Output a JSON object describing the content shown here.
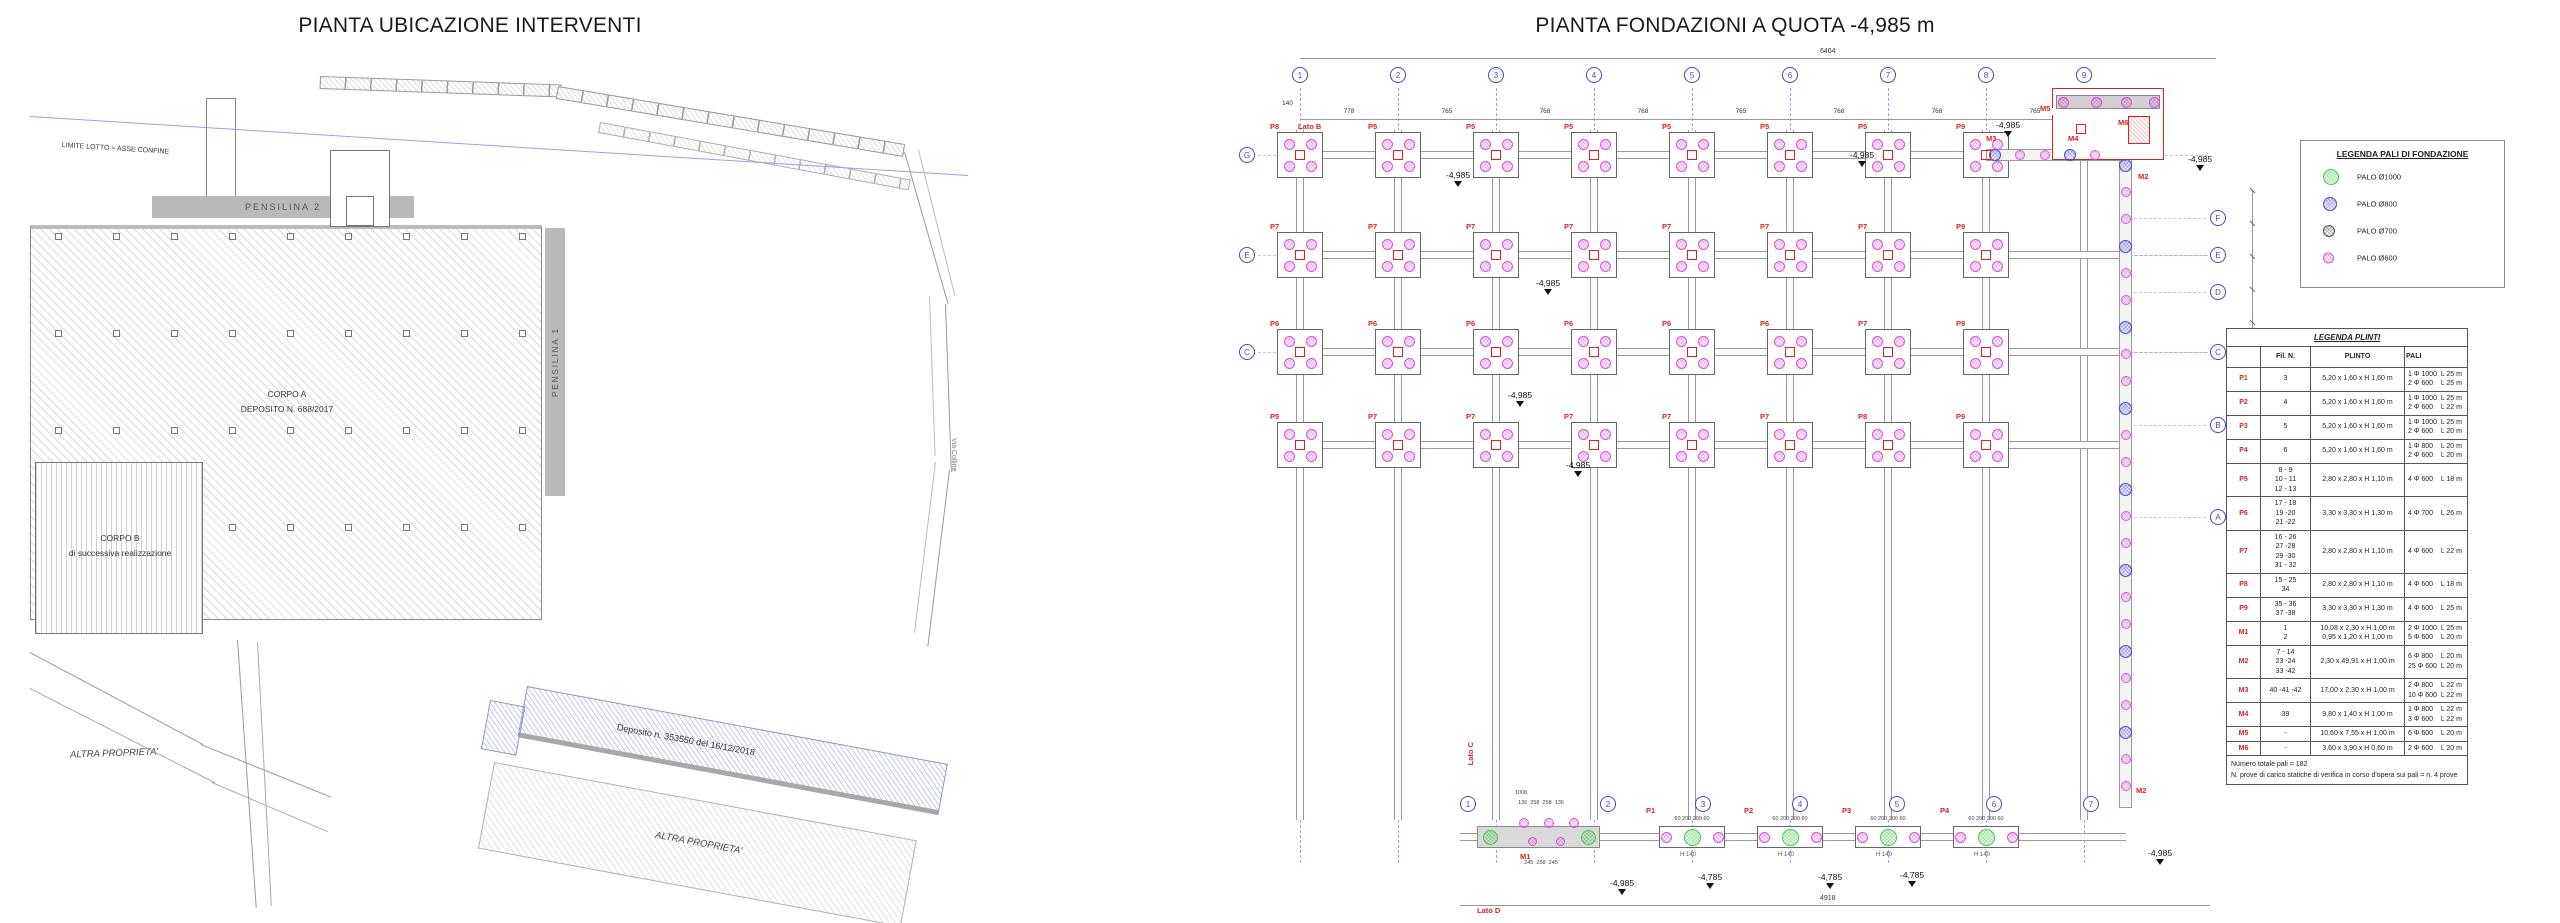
{
  "colors": {
    "palo_1000": "#44cc44",
    "palo_800": "#4a4ae8",
    "palo_700": "#555555",
    "palo_600": "#e050e0",
    "axis_blue": "#7d7de0",
    "red": "#e02020"
  },
  "left_plan": {
    "title": "PIANTA UBICAZIONE INTERVENTI",
    "labels": {
      "limite_lotto": "LIMITE LOTTO = ASSE CONFINE",
      "pensilina2": "PENSILINA  2",
      "pensilina1": "PENSILINA  1",
      "corpo_a_line1": "CORPO A",
      "corpo_a_line2": "DEPOSITO N. 688/2017",
      "corpo_b_line1": "CORPO B",
      "corpo_b_line2": "di successiva realizzazione",
      "deposito": "Deposito n. 353550 del 16/12/2018",
      "altra_proprieta_1": "ALTRA PROPRIETA'",
      "altra_proprieta_2": "ALTRA PROPRIETA'",
      "via": "Via Colline"
    }
  },
  "right_plan": {
    "title": "PIANTA FONDAZIONI A QUOTA -4,985 m",
    "axes_top": [
      "1",
      "2",
      "3",
      "4",
      "5",
      "6",
      "7",
      "8",
      "9"
    ],
    "axes_bottom": [
      "1",
      "2",
      "3",
      "4",
      "5",
      "6",
      "7"
    ],
    "axes_left": [
      "G",
      "E",
      "C"
    ],
    "axes_right": [
      "F",
      "E",
      "D",
      "C",
      "B",
      "A"
    ],
    "dims": {
      "top_overall": "6464",
      "bays": [
        "778",
        "765",
        "768",
        "768",
        "765",
        "768",
        "768",
        "765"
      ],
      "bottom_overall": "4918",
      "left_tick": "140"
    },
    "lato": {
      "top": "Lato B",
      "left": "Lato C",
      "bottom": "Lato D"
    },
    "cap_labels": [
      [
        "P8",
        "P5",
        "P5",
        "P5",
        "P5",
        "P5",
        "P5",
        "P9"
      ],
      [
        "P7",
        "P7",
        "P7",
        "P7",
        "P7",
        "P7",
        "P7",
        "P9"
      ],
      [
        "P6",
        "P6",
        "P6",
        "P6",
        "P6",
        "P6",
        "P7",
        "P9"
      ],
      [
        "P5",
        "P7",
        "P7",
        "P7",
        "P7",
        "P7",
        "P8",
        "P9"
      ]
    ],
    "elevations": [
      {
        "x": 1446,
        "y": 170,
        "t": "-4,985"
      },
      {
        "x": 1536,
        "y": 278,
        "t": "-4,985"
      },
      {
        "x": 1508,
        "y": 390,
        "t": "-4,985"
      },
      {
        "x": 1566,
        "y": 460,
        "t": "-4,985"
      },
      {
        "x": 1850,
        "y": 150,
        "t": "-4,985"
      },
      {
        "x": 1996,
        "y": 120,
        "t": "-4,985"
      },
      {
        "x": 2188,
        "y": 154,
        "t": "-4,985"
      },
      {
        "x": 1610,
        "y": 878,
        "t": "-4,985"
      },
      {
        "x": 1698,
        "y": 872,
        "t": "-4,785"
      },
      {
        "x": 1818,
        "y": 872,
        "t": "-4,785"
      },
      {
        "x": 1900,
        "y": 870,
        "t": "-4,785"
      },
      {
        "x": 2148,
        "y": 848,
        "t": "-4,985"
      }
    ],
    "m_labels": [
      {
        "t": "M2",
        "x": 2138,
        "y": 172
      },
      {
        "t": "M2",
        "x": 2136,
        "y": 786
      },
      {
        "t": "M3",
        "x": 1986,
        "y": 134
      },
      {
        "t": "M4",
        "x": 2068,
        "y": 134
      },
      {
        "t": "M5",
        "x": 2040,
        "y": 104
      },
      {
        "t": "M6",
        "x": 2118,
        "y": 118
      }
    ],
    "m1": {
      "label": "M1",
      "top_width": "1008",
      "dims_top": "136  258  258  136",
      "dims_bottom": "245  258  245"
    },
    "bottom_caps": [
      {
        "label": "P1"
      },
      {
        "label": "P2"
      },
      {
        "label": "P3"
      },
      {
        "label": "P4"
      }
    ],
    "bottom_cap_dims": "60  200  200  60",
    "bottom_cap_h": "H 140",
    "legend": {
      "title": "LEGENDA PALI DI FONDAZIONE",
      "items": [
        {
          "label": "PALO Ø1000",
          "color": "#44cc44",
          "d": 16
        },
        {
          "label": "PALO Ø800",
          "color": "#4a4ae8",
          "d": 14
        },
        {
          "label": "PALO  Ø700",
          "color": "#555555",
          "d": 12
        },
        {
          "label": "PALO  Ø600",
          "color": "#e050e0",
          "d": 11
        }
      ]
    },
    "plinti_table": {
      "title": "LEGENDA PLINTI",
      "headers": [
        "",
        "Fil. N.",
        "PLINTO",
        "PALI"
      ],
      "rows": [
        {
          "code": "P1",
          "fil": [
            "3"
          ],
          "plinto": [
            "5,20 x 1,60 x H 1,60 m"
          ],
          "pali": [
            "1 Φ 1000  L 25 m",
            "2 Φ 600    L 25 m"
          ]
        },
        {
          "code": "P2",
          "fil": [
            "4"
          ],
          "plinto": [
            "5,20 x 1,60 x H 1,60 m"
          ],
          "pali": [
            "1 Φ 1000  L 25 m",
            "2 Φ 600    L 22 m"
          ]
        },
        {
          "code": "P3",
          "fil": [
            "5"
          ],
          "plinto": [
            "5,20 x 1,60 x H 1,60 m"
          ],
          "pali": [
            "1 Φ 1000  L 25 m",
            "2 Φ 600    L 20 m"
          ]
        },
        {
          "code": "P4",
          "fil": [
            "6"
          ],
          "plinto": [
            "5,20 x 1,60 x H 1,60 m"
          ],
          "pali": [
            "1 Φ 800    L 20 m",
            "2 Φ 600    L 20 m"
          ]
        },
        {
          "code": "P5",
          "fil": [
            "8 - 9",
            "10 - 11",
            "12 - 13"
          ],
          "plinto": [
            "2,80 x 2,80 x H 1,10 m"
          ],
          "pali": [
            "4 Φ 600    L 18 m"
          ]
        },
        {
          "code": "P6",
          "fil": [
            "17 - 18",
            "19 -20",
            "21 -22"
          ],
          "plinto": [
            "3,30 x 3,30 x H 1,30 m"
          ],
          "pali": [
            "4 Φ 700    L 26 m"
          ]
        },
        {
          "code": "P7",
          "fil": [
            "16 - 26",
            "27 -28",
            "29 -30",
            "31 - 32"
          ],
          "plinto": [
            "2,80 x 2,80 x H 1,10 m"
          ],
          "pali": [
            "4 Φ 600    L 22 m"
          ]
        },
        {
          "code": "P8",
          "fil": [
            "15 - 25",
            "34"
          ],
          "plinto": [
            "2,80 x 2,80 x H 1,10 m"
          ],
          "pali": [
            "4 Φ 600    L 18 m"
          ]
        },
        {
          "code": "P9",
          "fil": [
            "35 - 36",
            "37 -38"
          ],
          "plinto": [
            "3,30 x 3,30 x H 1,30 m"
          ],
          "pali": [
            "4 Φ 600    L 25 m"
          ]
        },
        {
          "code": "M1",
          "fil": [
            "1",
            "2"
          ],
          "plinto": [
            "10,08 x 2,30 x H 1,00 m",
            "0,95 x 1,20  x H 1,00 m"
          ],
          "pali": [
            "2 Φ 1000  L 25 m",
            "5 Φ 600    L 20 m"
          ]
        },
        {
          "code": "M2",
          "fil": [
            "7 - 14",
            "23 -24",
            "33 -42"
          ],
          "plinto": [
            "2,30 x 49,91 x H 1,00 m"
          ],
          "pali": [
            "6 Φ 800    L 20 m",
            "25 Φ 600  L 20 m"
          ]
        },
        {
          "code": "M3",
          "fil": [
            "40 -41 -42"
          ],
          "plinto": [
            "17,00 x 2,30 x H 1,00 m"
          ],
          "pali": [
            "2 Φ 800    L 22 m",
            "10 Φ 600  L 22 m"
          ]
        },
        {
          "code": "M4",
          "fil": [
            "39"
          ],
          "plinto": [
            "9,80 x 1,40 x H 1,00 m"
          ],
          "pali": [
            "1 Φ 800    L 22 m",
            "3 Φ 600    L 22 m"
          ]
        },
        {
          "code": "M5",
          "fil": [
            "-"
          ],
          "plinto": [
            "10,60 x 7,55  x H 1,00 m"
          ],
          "pali": [
            "6 Φ 600    L 20 m"
          ]
        },
        {
          "code": "M6",
          "fil": [
            "-"
          ],
          "plinto": [
            "3,60 x 3,90 x H 0,60 m"
          ],
          "pali": [
            "2 Φ 600    L 20 m"
          ]
        }
      ],
      "footer": [
        "Numero totale pali =    182",
        "N. prove di carico statiche di verifica in corso d'opera sui pali = n. 4 prove"
      ]
    }
  }
}
